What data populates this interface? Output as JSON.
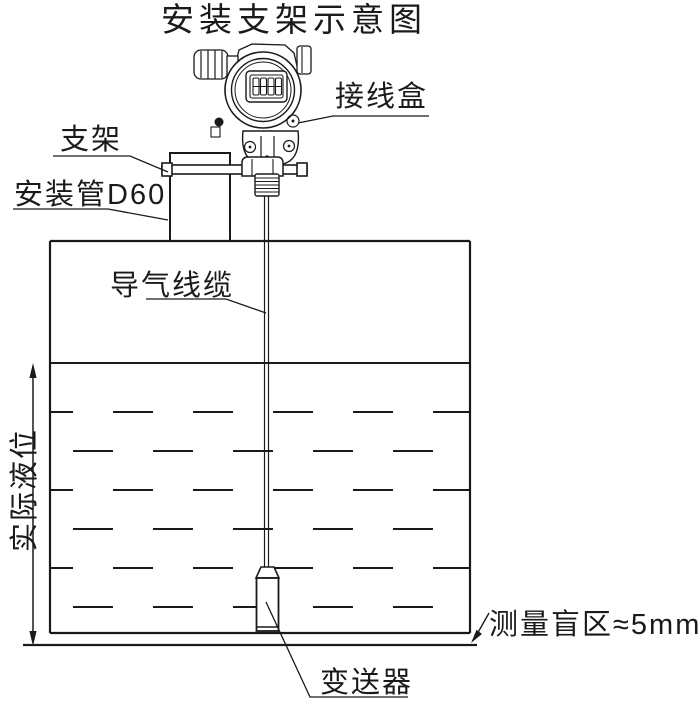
{
  "page": {
    "background": "#ffffff",
    "line_color": "#1a1a1a"
  },
  "diagram": {
    "title": "安装支架示意图",
    "labels": {
      "junction_box": "接线盒",
      "bracket": "支架",
      "mounting_pipe": "安装管D60",
      "air_cable": "导气线缆",
      "actual_level": "实际液位",
      "blind_zone": "测量盲区≈5mm",
      "transmitter": "变送器"
    },
    "display": {
      "digits": "8888"
    }
  }
}
